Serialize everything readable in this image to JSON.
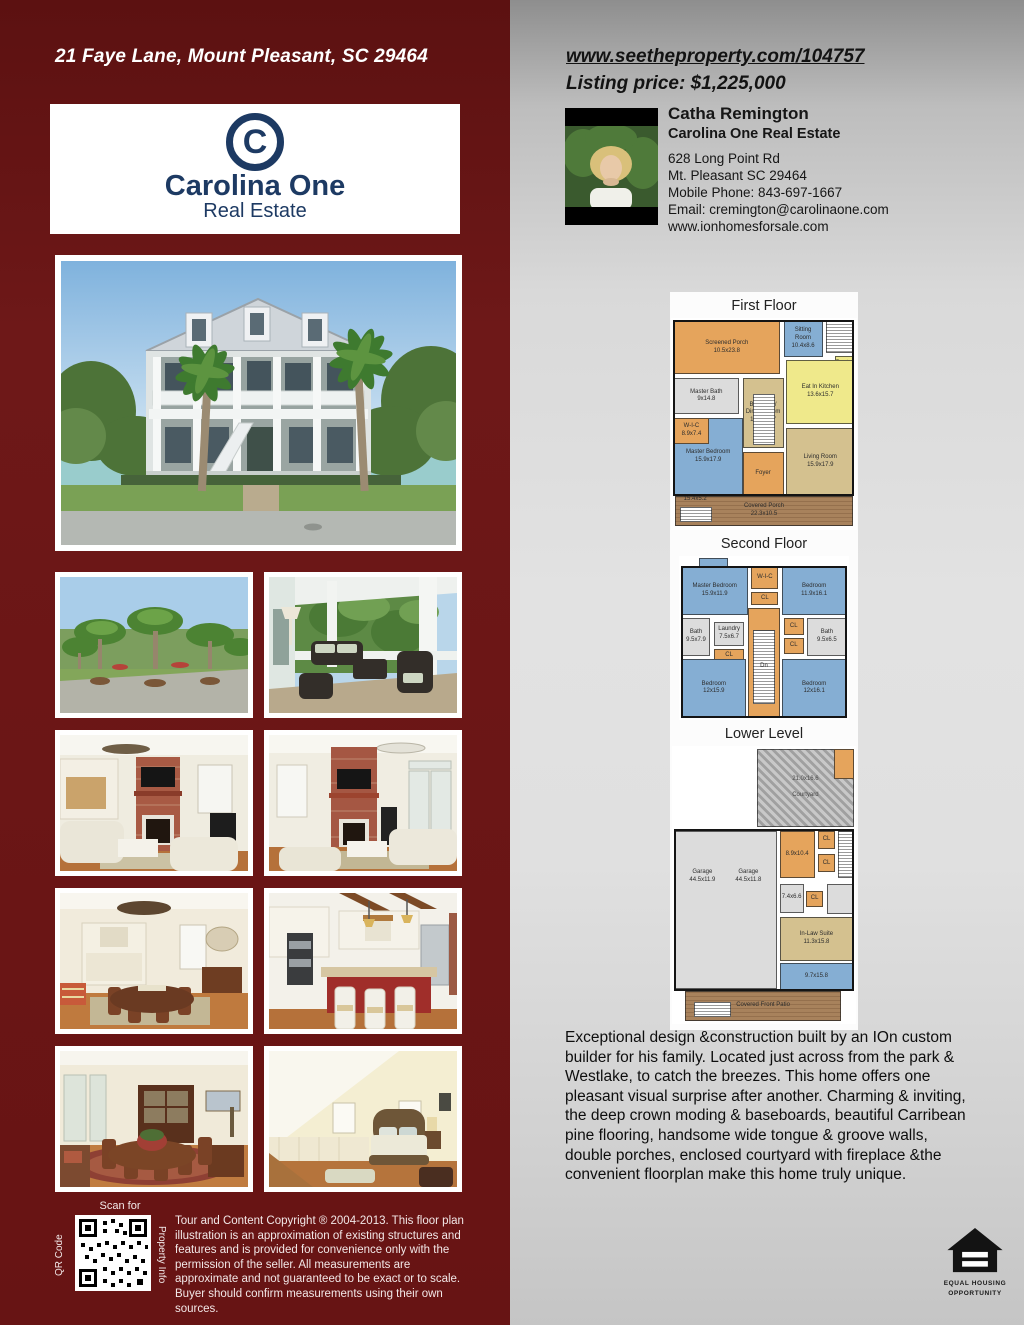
{
  "left_panel": {
    "address": "21 Faye Lane, Mount Pleasant, SC 29464",
    "logo": {
      "monogram": "C",
      "brand": "Carolina One",
      "sub": "Real Estate"
    },
    "qr": {
      "top": "Scan for",
      "left": "QR Code",
      "right": "Property Info"
    },
    "copyright": "Tour and Content Copyright ® 2004-2013. This floor plan illustration is an approximation of existing structures and features and is provided for convenience only with the permission of the seller. All measurements are approximate and not guaranteed to be exact or to scale. Buyer should confirm measurements using their own sources."
  },
  "right_panel": {
    "website": "www.seetheproperty.com/104757",
    "price": "Listing price: $1,225,000",
    "agent": {
      "name": "Catha Remington",
      "company": "Carolina One Real Estate",
      "address1": "628 Long Point Rd",
      "address2": "Mt. Pleasant SC 29464",
      "phone": "Mobile Phone: 843-697-1667",
      "email": "Email: cremington@carolinaone.com",
      "website": "www.ionhomesforsale.com"
    },
    "description": "Exceptional design &construction built by an IOn custom builder for his family. Located just across from the park & Westlake, to catch the breezes. This home offers one pleasant visual surprise after another. Charming & inviting, the deep crown moding & baseboards, beautiful Carribean pine flooring, handsome wide tongue & groove walls, double porches, enclosed courtyard with fireplace &the convenient floorplan make this home truly unique.",
    "eho": {
      "line1": "EQUAL HOUSING",
      "line2": "OPPORTUNITY"
    }
  },
  "floorplan_colors": {
    "orange": "#e5a45c",
    "blue": "#85aed3",
    "yellow": "#efe98b",
    "tan": "#d4c18f",
    "gray": "#dcdcdc",
    "stairs": "#ffffff",
    "pavers": "#b3b3b3",
    "wood": "#a8825c",
    "none": "transparent",
    "outline": "transparent"
  },
  "floorplans": [
    {
      "title": "First Floor",
      "box": {
        "w": 186,
        "h": 212
      },
      "rooms": [
        {
          "type": "wood",
          "x": 2,
          "y": 84,
          "w": 96,
          "h": 14,
          "label": "Covered Porch\n22.3x10.5"
        },
        {
          "type": "none",
          "x": 3,
          "y": 83,
          "w": 20,
          "h": 6,
          "label": "15.4x5.2"
        },
        {
          "type": "stairs",
          "x": 5,
          "y": 89,
          "w": 17,
          "h": 7
        },
        {
          "type": "orange",
          "x": 1.5,
          "y": 1.5,
          "w": 57,
          "h": 25,
          "label": "Screened Porch\n10.5x23.8"
        },
        {
          "type": "blue",
          "x": 60.5,
          "y": 1.5,
          "w": 21,
          "h": 17,
          "label": "Sitting\nRoom\n10.4x8.6"
        },
        {
          "type": "stairs",
          "x": 83.5,
          "y": 1.5,
          "w": 15,
          "h": 15
        },
        {
          "type": "yellow",
          "x": 88,
          "y": 18,
          "w": 10.5,
          "h": 7.5,
          "label": "Pantry"
        },
        {
          "type": "yellow",
          "x": 62,
          "y": 20,
          "w": 36.5,
          "h": 30,
          "label": "Eat In Kitchen\n13.6x15.7"
        },
        {
          "type": "gray",
          "x": 1.5,
          "y": 28.5,
          "w": 35,
          "h": 17,
          "label": "Master Bath\n9x14.8"
        },
        {
          "type": "tan",
          "x": 38.5,
          "y": 28.5,
          "w": 22,
          "h": 33,
          "label": "Breakfast/\nDining Room\n11.8x15.7"
        },
        {
          "type": "blue",
          "x": 1.5,
          "y": 47,
          "w": 37,
          "h": 37,
          "label": "Master Bedroom\n15.9x17.9"
        },
        {
          "type": "orange",
          "x": 1.5,
          "y": 47,
          "w": 19,
          "h": 12.5,
          "label": "W-I-C\n8.9x7.4"
        },
        {
          "type": "stairs",
          "x": 44,
          "y": 36,
          "w": 12,
          "h": 24
        },
        {
          "type": "orange",
          "x": 38.5,
          "y": 63,
          "w": 22,
          "h": 21,
          "label": "Foyer"
        },
        {
          "type": "tan",
          "x": 62,
          "y": 52,
          "w": 36.5,
          "h": 32,
          "label": "Living Room\n15.9x17.9"
        },
        {
          "type": "outline",
          "x": 1,
          "y": 1,
          "w": 97.5,
          "h": 83
        }
      ]
    },
    {
      "title": "Second Floor",
      "box": {
        "w": 170,
        "h": 164
      },
      "rooms": [
        {
          "type": "blue",
          "x": 12,
          "y": 1,
          "w": 17,
          "h": 9
        },
        {
          "type": "blue",
          "x": 1.5,
          "y": 7,
          "w": 39,
          "h": 29,
          "label": "Master Bedroom\n15.9x11.9"
        },
        {
          "type": "orange",
          "x": 42.5,
          "y": 7,
          "w": 16,
          "h": 13,
          "label": "W-I-C"
        },
        {
          "type": "orange",
          "x": 42.5,
          "y": 22,
          "w": 16,
          "h": 8,
          "label": "CL"
        },
        {
          "type": "blue",
          "x": 60.5,
          "y": 7,
          "w": 38,
          "h": 29,
          "label": "Bedroom\n11.9x16.1"
        },
        {
          "type": "gray",
          "x": 1.5,
          "y": 38,
          "w": 17,
          "h": 23,
          "label": "Bath\n9.5x7.9"
        },
        {
          "type": "gray",
          "x": 20.5,
          "y": 40,
          "w": 18,
          "h": 15,
          "label": "Laundry\n7.5x6.7"
        },
        {
          "type": "orange",
          "x": 20.5,
          "y": 57,
          "w": 18,
          "h": 8,
          "label": "CL"
        },
        {
          "type": "orange",
          "x": 40.5,
          "y": 32,
          "w": 19,
          "h": 66.5
        },
        {
          "type": "stairs",
          "x": 43.5,
          "y": 45,
          "w": 13,
          "h": 45,
          "label": "Dn"
        },
        {
          "type": "orange",
          "x": 61.5,
          "y": 38,
          "w": 12,
          "h": 10,
          "label": "CL"
        },
        {
          "type": "orange",
          "x": 61.5,
          "y": 50,
          "w": 12,
          "h": 10,
          "label": "CL"
        },
        {
          "type": "gray",
          "x": 75.5,
          "y": 38,
          "w": 23,
          "h": 23,
          "label": "Bath\n9.5x6.5"
        },
        {
          "type": "blue",
          "x": 1.5,
          "y": 63,
          "w": 38,
          "h": 35.5,
          "label": "Bedroom\n12x15.9"
        },
        {
          "type": "blue",
          "x": 60.5,
          "y": 63,
          "w": 38,
          "h": 35.5,
          "label": "Bedroom\n12x16.1"
        },
        {
          "type": "outline",
          "x": 1,
          "y": 6,
          "w": 98,
          "h": 93
        }
      ]
    },
    {
      "title": "Lower Level",
      "box": {
        "w": 184,
        "h": 278
      },
      "rooms": [
        {
          "type": "pavers",
          "x": 46,
          "y": 1,
          "w": 53,
          "h": 28,
          "label": "21.0x16.6\n\nCourtyard"
        },
        {
          "type": "orange",
          "x": 88,
          "y": 1,
          "w": 11,
          "h": 11
        },
        {
          "type": "wood",
          "x": 7,
          "y": 88,
          "w": 85,
          "h": 11,
          "label": "Covered Front Patio"
        },
        {
          "type": "stairs",
          "x": 12,
          "y": 92,
          "w": 20,
          "h": 5.5
        },
        {
          "type": "gray",
          "x": 1.5,
          "y": 30.5,
          "w": 55.5,
          "h": 57
        },
        {
          "type": "none",
          "x": 4,
          "y": 38,
          "w": 25,
          "h": 18,
          "label": "Garage\n44.5x11.9"
        },
        {
          "type": "none",
          "x": 29,
          "y": 38,
          "w": 25,
          "h": 18,
          "label": "Garage\n44.5x11.8"
        },
        {
          "type": "orange",
          "x": 58.5,
          "y": 30.5,
          "w": 19,
          "h": 17,
          "label": "8.9x10.4"
        },
        {
          "type": "orange",
          "x": 79.5,
          "y": 30.5,
          "w": 9,
          "h": 6.5,
          "label": "CL"
        },
        {
          "type": "orange",
          "x": 79.5,
          "y": 39,
          "w": 9,
          "h": 6.5,
          "label": "CL"
        },
        {
          "type": "stairs",
          "x": 90,
          "y": 30.5,
          "w": 8.5,
          "h": 17
        },
        {
          "type": "gray",
          "x": 58.5,
          "y": 49.5,
          "w": 13,
          "h": 10.5,
          "label": "7.4x6.6"
        },
        {
          "type": "orange",
          "x": 73,
          "y": 52,
          "w": 9,
          "h": 6,
          "label": "CL"
        },
        {
          "type": "gray",
          "x": 84,
          "y": 49.5,
          "w": 14.5,
          "h": 11
        },
        {
          "type": "tan",
          "x": 58.5,
          "y": 61.5,
          "w": 40,
          "h": 16,
          "label": "In-Law Suite\n11.3x15.8"
        },
        {
          "type": "blue",
          "x": 58.5,
          "y": 78,
          "w": 40,
          "h": 10,
          "label": "9.7x15.8"
        },
        {
          "type": "outline",
          "x": 1,
          "y": 30,
          "w": 98,
          "h": 58
        }
      ]
    }
  ]
}
